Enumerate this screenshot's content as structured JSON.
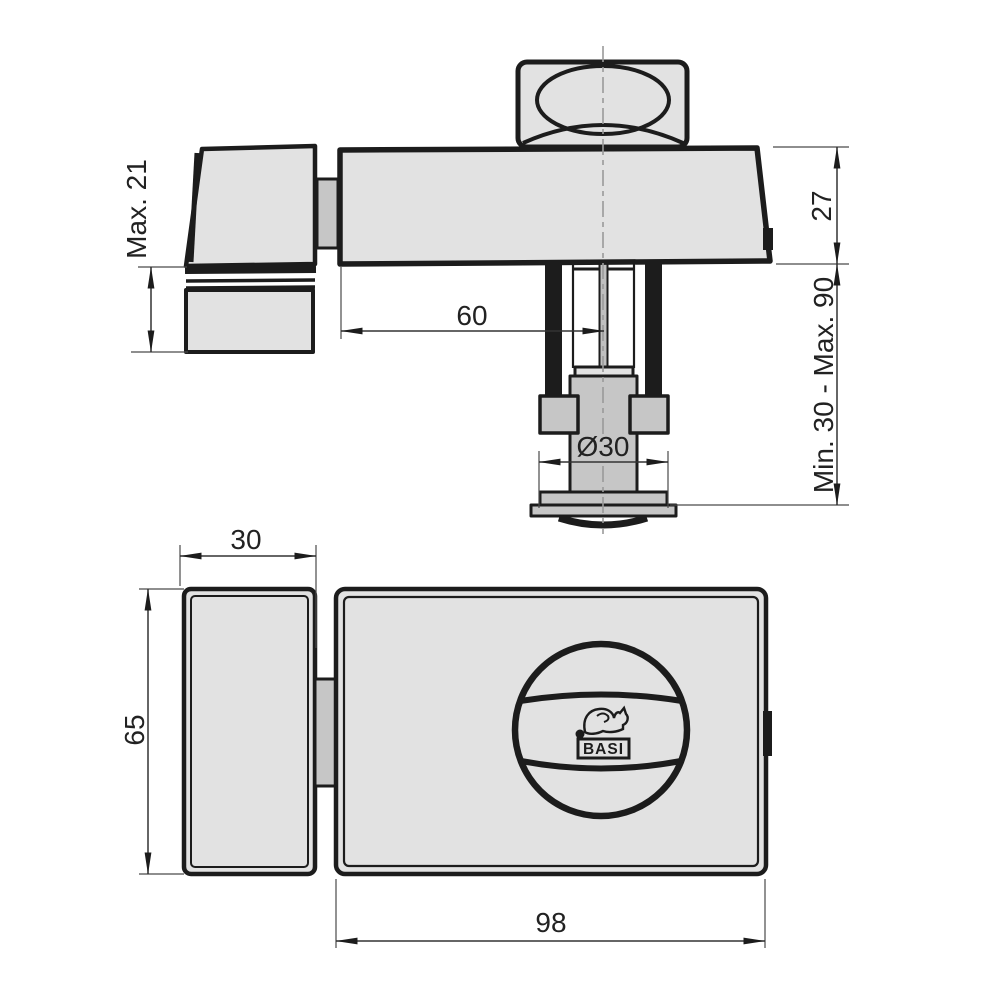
{
  "drawing": {
    "brand": "BASI",
    "dims": {
      "max21": "Max. 21",
      "h27": "27",
      "door_range": "Min. 30 - Max. 90",
      "backset60": "60",
      "dia30": "Ø30",
      "w30": "30",
      "h65": "65",
      "w98": "98"
    },
    "logo": {
      "text": "BASI"
    },
    "colors": {
      "part_fill": "#e2e2e2",
      "part_mid": "#c6c6c6",
      "line": "#1c1c1c",
      "dim_line": "#333333",
      "centerline": "#9a9a9a",
      "background": "#ffffff"
    }
  }
}
